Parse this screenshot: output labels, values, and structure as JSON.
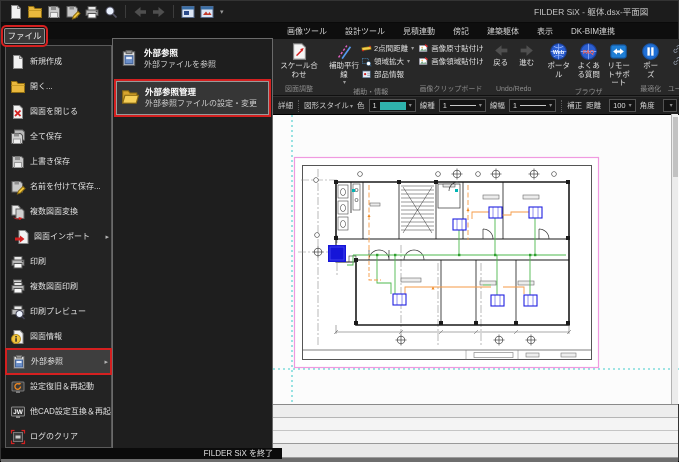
{
  "window": {
    "title": "FILDER SiX - 躯体.dsx-平面図"
  },
  "quick_access": {
    "overflow_glyph": "▾",
    "icons": [
      "new-document",
      "open-folder",
      "save",
      "save-as",
      "print",
      "print-preview",
      "undo",
      "redo",
      "drawing-window",
      "image-window"
    ]
  },
  "file_button": {
    "label": "ファイル"
  },
  "file_menu": {
    "items": [
      {
        "label": "新規作成",
        "icon": "new-document-icon"
      },
      {
        "label": "開く...",
        "icon": "open-folder-icon"
      },
      {
        "label": "図面を閉じる",
        "icon": "close-drawing-icon"
      },
      {
        "label": "全て保存",
        "icon": "save-all-icon"
      },
      {
        "label": "上書き保存",
        "icon": "save-icon"
      },
      {
        "label": "名前を付けて保存...",
        "icon": "save-as-icon"
      },
      {
        "label": "複数図面変換",
        "icon": "convert-drawings-icon"
      },
      {
        "label": "図面インポート",
        "icon": "import-drawing-icon",
        "has_submenu": true
      },
      {
        "label": "印刷",
        "icon": "print-icon"
      },
      {
        "label": "複数図面印刷",
        "icon": "print-multiple-icon"
      },
      {
        "label": "印刷プレビュー",
        "icon": "print-preview-icon"
      },
      {
        "label": "図面情報",
        "icon": "drawing-info-icon"
      },
      {
        "label": "外部参照",
        "icon": "external-reference-icon",
        "has_submenu": true,
        "selected": true,
        "highlighted": true
      },
      {
        "label": "設定復旧＆再起動",
        "icon": "restore-settings-icon"
      },
      {
        "label": "他CAD設定互換＆再起動",
        "icon": "jw-cad-compat-icon"
      },
      {
        "label": "ログのクリア",
        "icon": "clear-log-icon"
      }
    ],
    "exit_label": "FILDER SiX を終了"
  },
  "submenu": {
    "items": [
      {
        "title": "外部参照",
        "subtitle": "外部ファイルを参照",
        "icon": "external-reference-icon"
      },
      {
        "title": "外部参照管理",
        "subtitle": "外部参照ファイルの設定・変更",
        "icon": "external-reference-manage-icon",
        "highlighted": true
      }
    ]
  },
  "ribbon": {
    "tabs": [
      {
        "label": "画像ツール"
      },
      {
        "label": "設計ツール"
      },
      {
        "label": "見積連動"
      },
      {
        "label": "傍記"
      },
      {
        "label": "建築躯体"
      },
      {
        "label": "表示"
      },
      {
        "label": "DK-BIM連携"
      }
    ],
    "groups": {
      "drawing_adjust": {
        "label": "図面調整",
        "scale_button": "スケール合わせ"
      },
      "assist_info": {
        "label": "補助・情報",
        "parallel_button": "補助平行線",
        "distance_button": "2点間距離",
        "zoom_area_button": "領域拡大",
        "part_info_button": "部品情報"
      },
      "image_clipboard": {
        "label": "画像クリップボード",
        "paste_original_button": "画像原寸貼付け",
        "paste_region_button": "画像領域貼付け"
      },
      "undo_redo": {
        "label": "Undo/Redo",
        "back_button": "戻る",
        "forward_button": "進む"
      },
      "browser": {
        "label": "ブラウザ",
        "portal_button": "ポータル",
        "faq_button": "よくある質問",
        "remote_button": "リモートサポート"
      },
      "optimize": {
        "label": "最適化",
        "pause_button": "ポーズ"
      },
      "user_tools": {
        "label": "ユーザーツール",
        "word_link": "Word",
        "excel_link": "Excel"
      }
    }
  },
  "style_toolbar": {
    "detail_label": "詳細",
    "shape_style_label": "図形スタイル",
    "color_label": "色",
    "color_value": "1",
    "line_type_label": "線種",
    "line_type_value": "1",
    "line_width_label": "線幅",
    "line_width_value": "1",
    "correction_label": "補正",
    "distance_label": "距離",
    "distance_value": "100",
    "angle_label": "角度"
  },
  "colors": {
    "highlight_red": "#d42020",
    "selection_teal_swatch": "#2fb3ad",
    "page_border_pink": "#f09ae0",
    "guide_cyan": "#00bcbc",
    "equipment_blue": "#2020e0",
    "pipe_green": "#4db84d",
    "pipe_orange": "#f59a45"
  }
}
